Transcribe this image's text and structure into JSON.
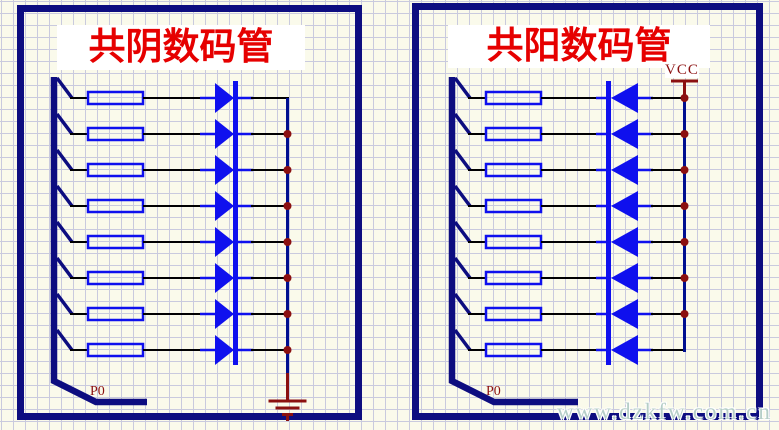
{
  "colors": {
    "bg": "#fafaeb",
    "grid": "#c9cade",
    "navy": "#0d0d80",
    "blue": "#0f10ee",
    "rail-blue": "#001090",
    "wire": "#000000",
    "dark-red": "#8b1010",
    "title-red": "#e60000",
    "watermark": "#b5cec8"
  },
  "left_panel": {
    "title": "共阴数码管",
    "bus_label": "P0",
    "segment_count": 8
  },
  "right_panel": {
    "title": "共阳数码管",
    "bus_label": "P0",
    "power_label": "VCC",
    "segment_count": 8
  },
  "watermark": "www.dzkfw.com.cn"
}
